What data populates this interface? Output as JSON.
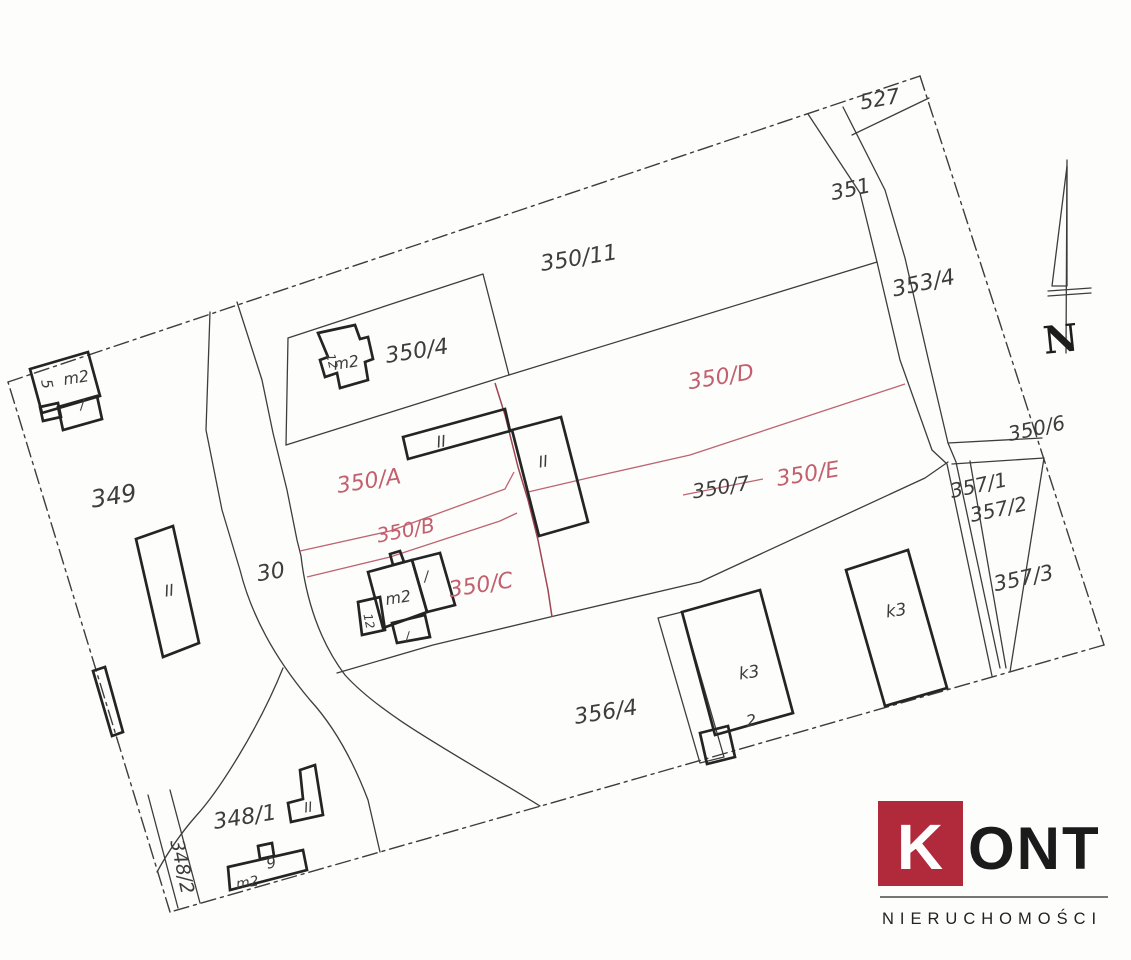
{
  "colors": {
    "ink": "#3d3d3d",
    "building_ink": "#242424",
    "red_line": "#bd6470",
    "red_dark": "#9e4452",
    "red_label": "#c2606e",
    "logo_red": "#b02a3b",
    "logo_text": "#1b1b1b",
    "paper": "#fdfdfc"
  },
  "labels": {
    "parcels": {
      "p527": "527",
      "p351": "351",
      "p353_4": "353/4",
      "p350_11": "350/11",
      "p350_4": "350/4",
      "p350_6": "350/6",
      "p350_7": "350/7",
      "p349": "349",
      "p30": "30",
      "p356_4": "356/4",
      "p357_1": "357/1",
      "p357_2": "357/2",
      "p357_3": "357/3",
      "p348_1": "348/1",
      "p348_2": "348/2",
      "pA": "350/A",
      "pB": "350/B",
      "pC": "350/C",
      "pD": "350/D",
      "pE": "350/E"
    },
    "buildings": {
      "m2": "m2",
      "ii": "II",
      "k3": "k3",
      "one": "/",
      "two": "2",
      "five": "5",
      "nine": "9",
      "twelve": "12"
    },
    "north": "N"
  },
  "logo": {
    "k": "K",
    "ont": "ONT",
    "subtitle": "NIERUCHOMOŚCI"
  }
}
